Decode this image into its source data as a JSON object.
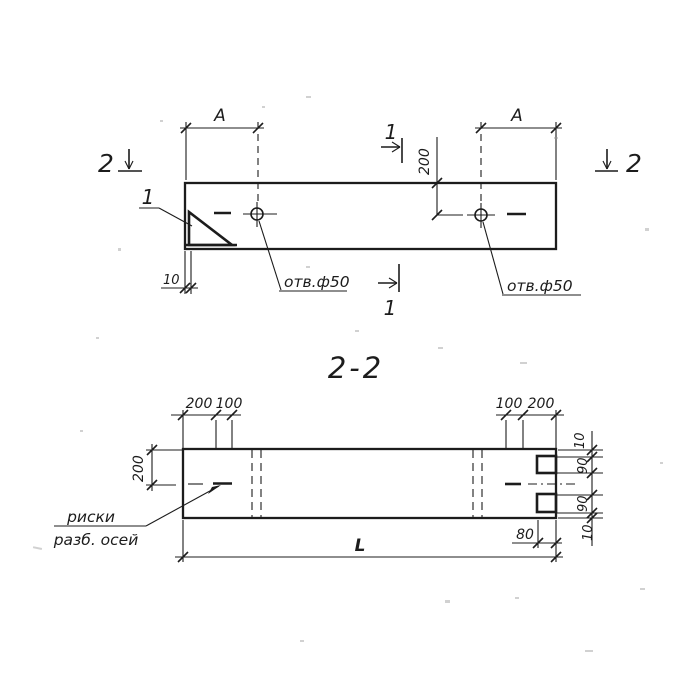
{
  "drawing_title": "2-2",
  "colors": {
    "ink": "#1c1c1c",
    "paper": "#ffffff"
  },
  "top_view": {
    "section2_left": "2",
    "section2_right": "2",
    "section1_top": "1",
    "section1_bottom": "1",
    "dim_a_left": "А",
    "dim_a_right": "А",
    "dim_200": "200",
    "dim_10": "10",
    "detail_label": "1",
    "hole_note_left": "отв.ф50",
    "hole_note_right": "отв.ф50"
  },
  "section_view": {
    "dims_top_left": [
      "200",
      "100"
    ],
    "dims_top_right": [
      "100",
      "200"
    ],
    "dim_height_200": "200",
    "dims_right_edge": [
      "10",
      "90",
      "90",
      "10"
    ],
    "dim_80": "80",
    "dim_length": "L",
    "axis_note_line1": "риски",
    "axis_note_line2": "разб. осей"
  }
}
